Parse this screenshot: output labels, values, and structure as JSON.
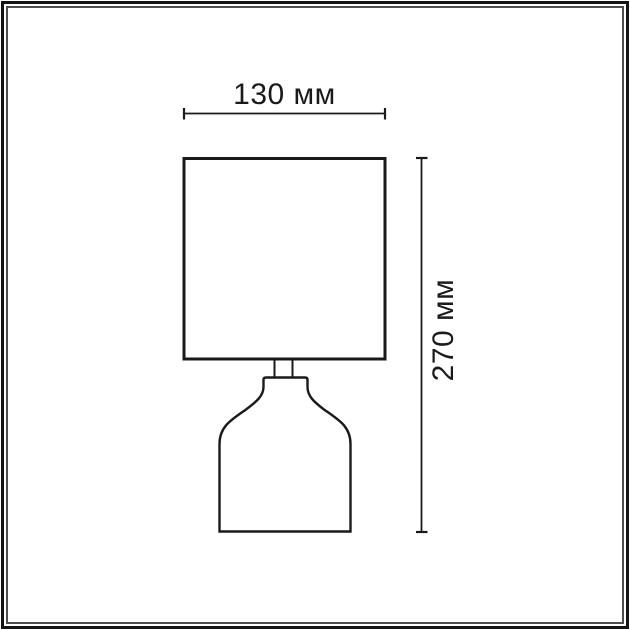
{
  "page": {
    "background_color": "#ffffff"
  },
  "frame": {
    "outer_border_color": "#141414",
    "inner_border_color": "#4d4d4d"
  },
  "diagram": {
    "subject": "table-lamp-outline-drawing",
    "line_color": "#1a1a1a",
    "text_color": "#1a1a1a",
    "width_dimension": {
      "label": "130 мм",
      "value_mm": 130
    },
    "height_dimension": {
      "label": "270 мм",
      "value_mm": 270
    }
  }
}
